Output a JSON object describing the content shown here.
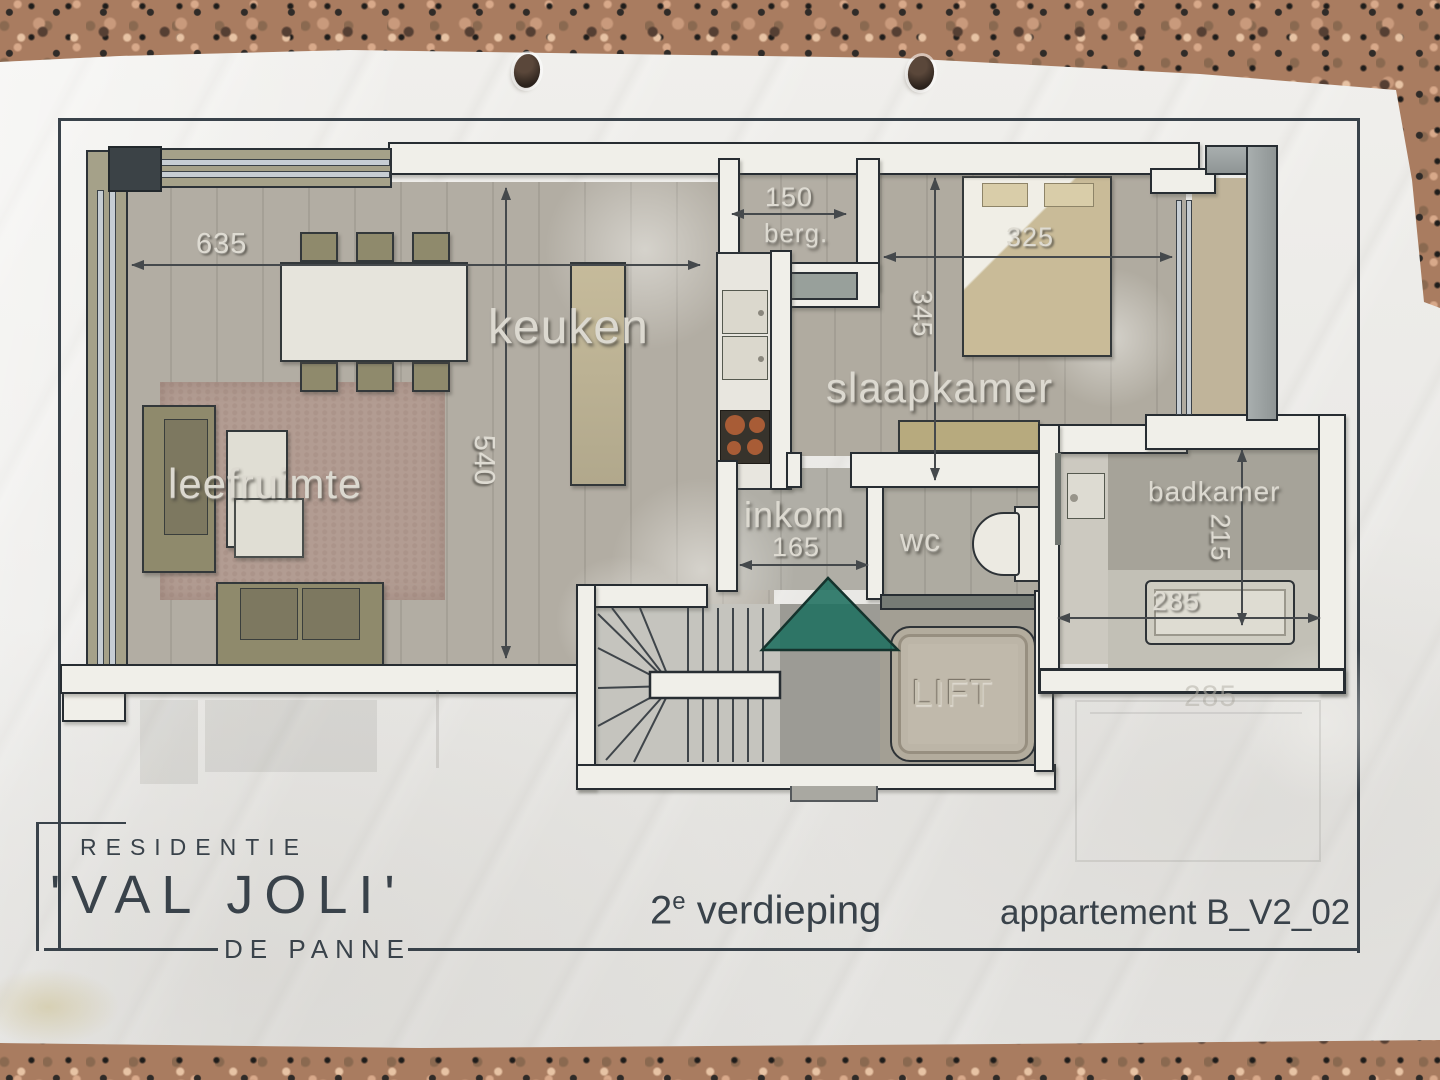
{
  "plan": {
    "rooms": {
      "kitchen": "keuken",
      "living": "leefruimte",
      "bedroom": "slaapkamer",
      "bathroom": "badkamer",
      "hall": "inkom",
      "toilet": "wc",
      "storage": "berg.",
      "lift": "LIFT"
    },
    "dimensions_cm": {
      "living_width": "635",
      "living_depth": "540",
      "storage_width": "150",
      "bedroom_width": "325",
      "bedroom_depth": "345",
      "hall_width": "165",
      "bathroom_depth": "215",
      "bathroom_width": "285",
      "neighbour_width": "285"
    },
    "colors": {
      "entrance_triangle": "#1f6f60",
      "wall_outline": "#272d32",
      "paper": "#e9e8e5",
      "granite_base": "#a97c60"
    }
  },
  "title_block": {
    "building_type": "RESIDENTIE",
    "residence_name": "'VAL JOLI'",
    "city": "DE PANNE"
  },
  "footer": {
    "floor_number": "2",
    "floor_suffix": "e",
    "floor_word": "verdieping",
    "apartment": "appartement B_V2_02"
  }
}
